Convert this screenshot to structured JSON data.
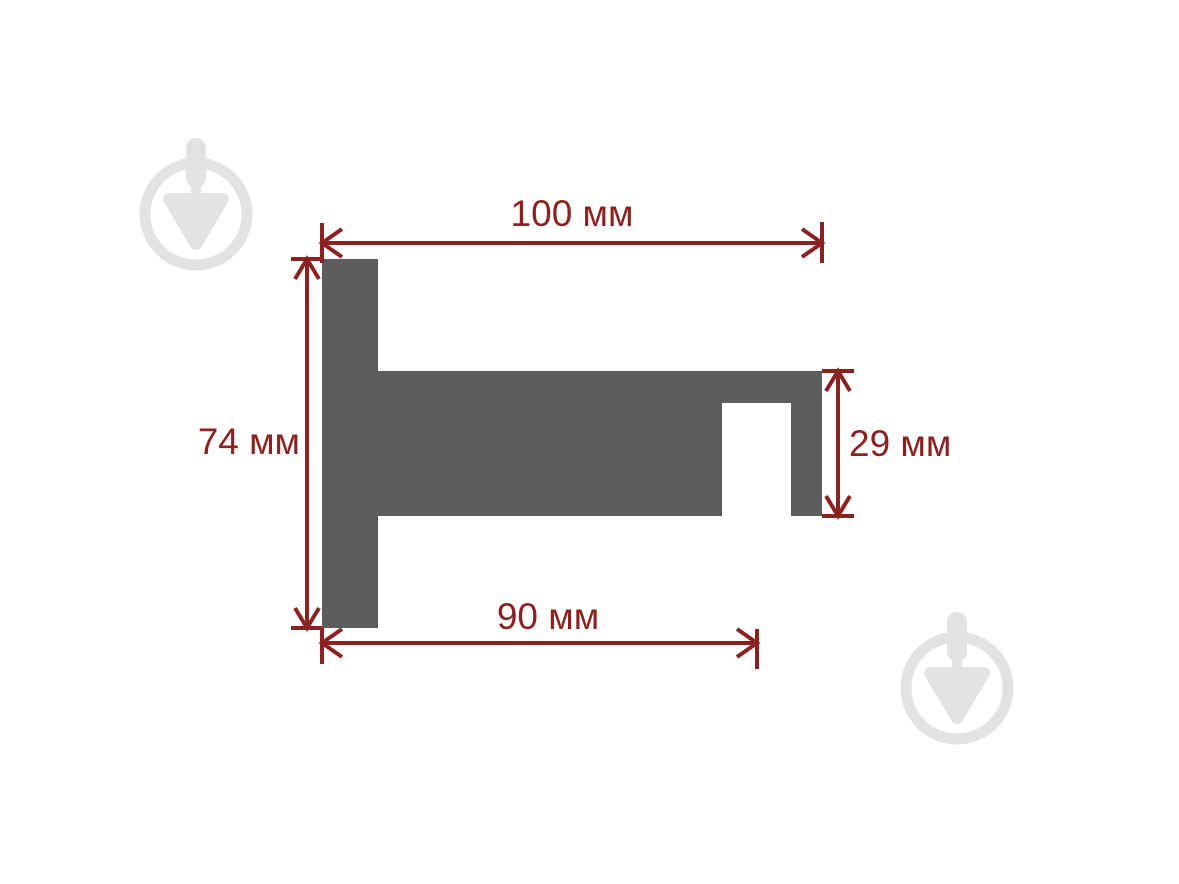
{
  "diagram": {
    "unit": "мм",
    "colors": {
      "shape": "#5d5d5d",
      "dimension": "#8b2222",
      "watermark": "#e2e2e2",
      "background": "#ffffff"
    },
    "dimensions": {
      "top_width": {
        "value": 100,
        "label": "100 мм"
      },
      "left_height": {
        "value": 74,
        "label": "74 мм"
      },
      "right_height": {
        "value": 29,
        "label": "29 мм"
      },
      "bottom_width": {
        "value": 90,
        "label": "90 мм"
      }
    },
    "watermark": {
      "icon": "trowel-in-circle-icon"
    }
  }
}
